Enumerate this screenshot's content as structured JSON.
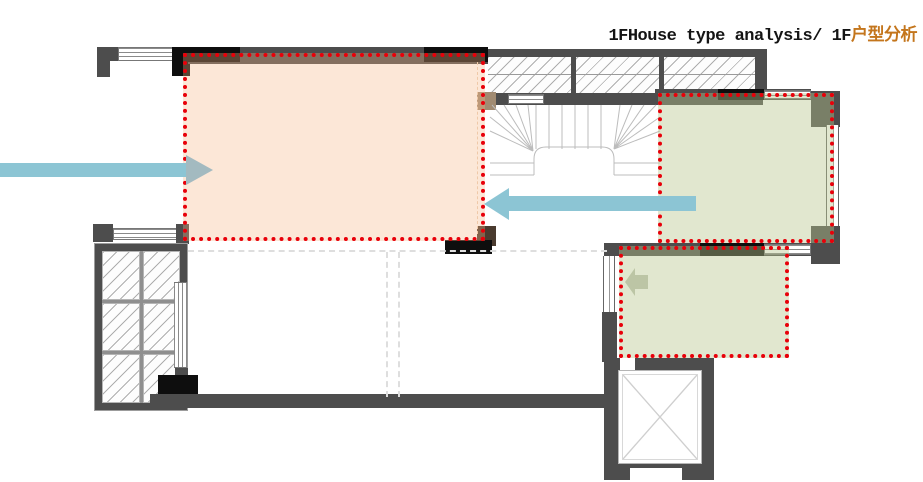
{
  "title": {
    "prefix": "1FHouse type analysis/ 1F",
    "suffix": "户型分析"
  },
  "colors": {
    "title_accent": "#c4761d",
    "zone_outline_red": "#e8000a",
    "zone_pink_fill": "#fce7d7",
    "zone_green_fill": "#e1e7cf",
    "arrow_blue": "#8cc5d4",
    "wall_gray": "#4d4d4d",
    "wall_black": "#0e0e0e"
  },
  "zones": [
    {
      "name": "pink-highlight-zone",
      "fill": "pink",
      "outline": "red-dotted"
    },
    {
      "name": "green-highlight-zone-upper-right",
      "fill": "green",
      "outline": "red-dotted"
    },
    {
      "name": "green-highlight-zone-lower-right",
      "fill": "green",
      "outline": "red-dotted"
    }
  ],
  "arrows": [
    {
      "name": "entry-flow-arrow-left",
      "direction": "right"
    },
    {
      "name": "circulation-arrow-middle",
      "direction": "left"
    },
    {
      "name": "mini-arrow-lower-green",
      "direction": "left"
    }
  ],
  "plan_features": [
    "staircase",
    "elevator-shaft",
    "bay-window",
    "glazed-wall"
  ]
}
